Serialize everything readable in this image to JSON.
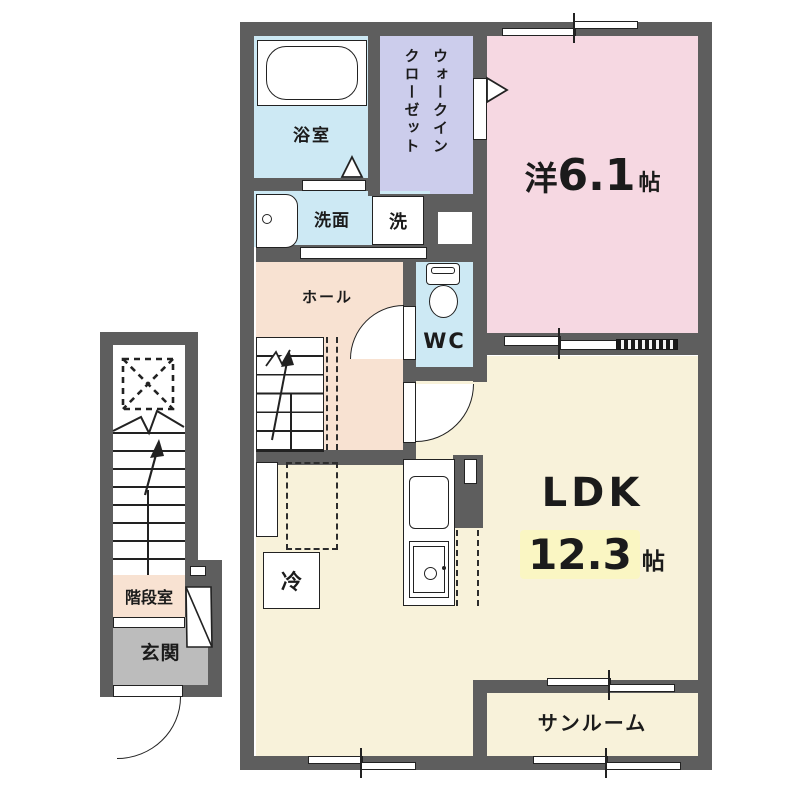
{
  "plan_title": "1-bedroom apartment floor plan (1LDK, 2nd floor with stairwell)",
  "rooms": {
    "bath": {
      "label": "浴室",
      "color": "#cde9f4"
    },
    "wic": {
      "line1": "ウォークイン",
      "line2": "クローゼット",
      "full_label": "ウォークインクローゼット",
      "color": "#cccdec"
    },
    "western": {
      "prefix": "洋",
      "size": "6.1",
      "unit": "帖",
      "color": "#f6d8e2"
    },
    "washroom": {
      "label": "洗面",
      "color": "#cde9f4"
    },
    "washer": {
      "label": "洗"
    },
    "hall": {
      "label": "ホール",
      "color": "#f8e2d2"
    },
    "wc": {
      "label": "WC",
      "color": "#cde9f4"
    },
    "ldk": {
      "name": "LDK",
      "size": "12.3",
      "unit": "帖",
      "color": "#f8f2da",
      "highlight": "#faf6c3"
    },
    "fridge": {
      "label": "冷"
    },
    "stair_room": {
      "label": "階段室",
      "color": "#f8e2d2"
    },
    "entrance": {
      "label": "玄関",
      "color": "#bcbcbc"
    },
    "sunroom": {
      "label": "サンルーム",
      "color": "#f8f2da"
    }
  },
  "colors": {
    "wall": "#5e5e5e",
    "line": "#222222",
    "background": "#ffffff"
  }
}
